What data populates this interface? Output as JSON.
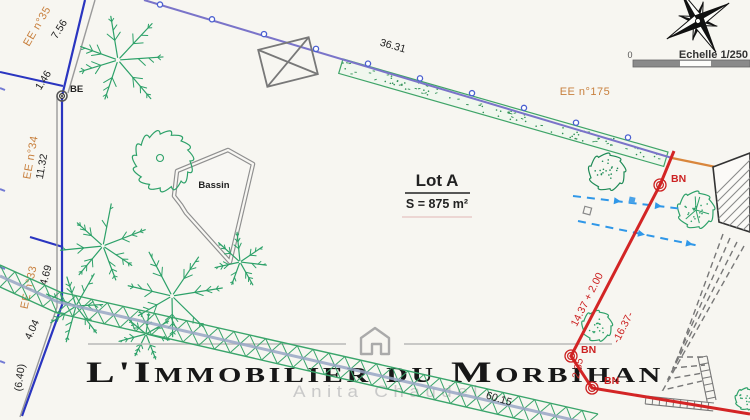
{
  "lot": {
    "name": "Lot A",
    "area": "S = 875 m²"
  },
  "labels": {
    "bassin": "Bassin",
    "be": "BE",
    "bn": "BN"
  },
  "parcels": {
    "ee175": "EE n°175",
    "ee35": "EE n°35",
    "ee34": "EE n°34",
    "ee33": "EE n°33"
  },
  "scalebar": {
    "zero": "0",
    "label": "Echelle 1/250"
  },
  "measurements": {
    "top": "36.31",
    "left1": "7.56",
    "left2": "1.46",
    "left3": "11.32",
    "left4": "4.69",
    "left5": "4.04",
    "left6": "(6.40)",
    "bottom": "60.15",
    "right1": "14.37 + 2.00",
    "right2": "-16.37-",
    "right3": "2.35"
  },
  "watermark": {
    "agency": "L'Immobilier du Morbihan",
    "agent": "Anita Chaudel"
  },
  "colors": {
    "boundary": "#7a74c9",
    "boundary_far": "#d9863c",
    "new_limit": "#d32525",
    "vegetation": "#2da169",
    "parcel_text": "#c8803e",
    "flow_arrow": "#2f97e8"
  }
}
